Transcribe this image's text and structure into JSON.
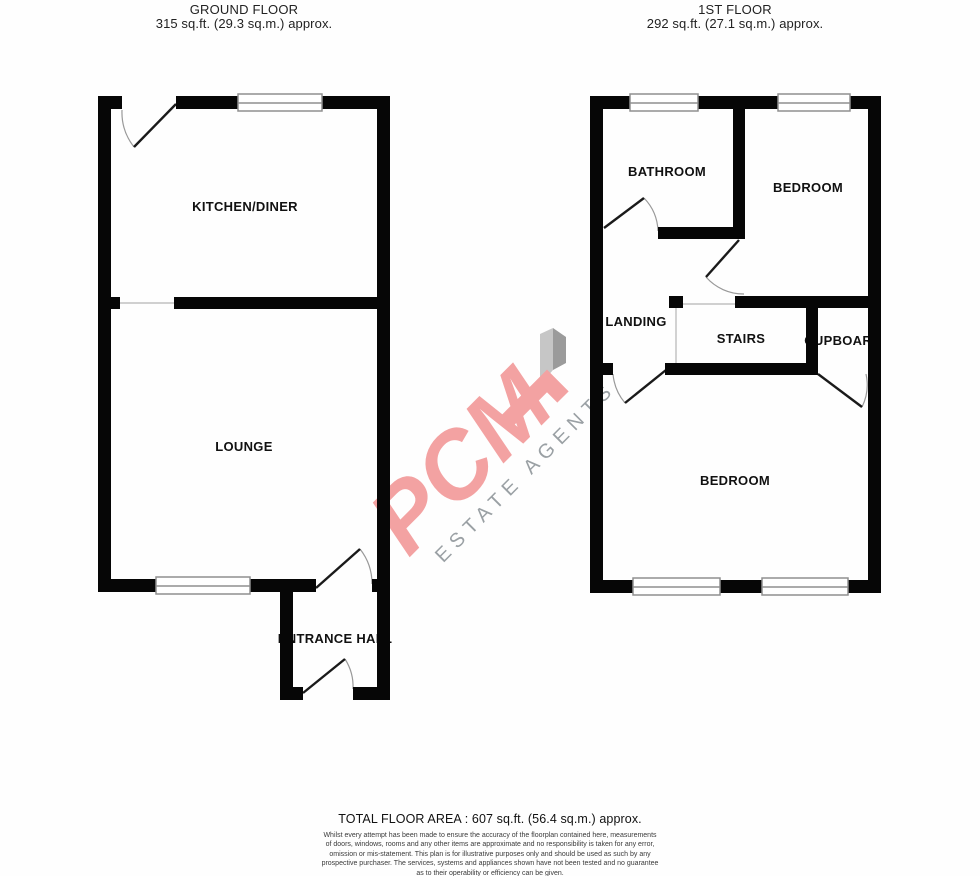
{
  "ground_floor": {
    "title": "GROUND FLOOR",
    "area": "315 sq.ft. (29.3 sq.m.) approx.",
    "rooms": {
      "kitchen_diner": "KITCHEN/DINER",
      "lounge": "LOUNGE",
      "entrance_hall": "ENTRANCE HALL"
    }
  },
  "first_floor": {
    "title": "1ST FLOOR",
    "area": "292 sq.ft. (27.1 sq.m.) approx.",
    "rooms": {
      "bathroom": "BATHROOM",
      "bedroom_front": "BEDROOM",
      "landing": "LANDING",
      "stairs": "STAIRS",
      "cupboard": "CUPBOARD",
      "bedroom_back": "BEDROOM"
    }
  },
  "watermark": {
    "brand": "PCM",
    "tagline": "ESTATE AGENTS",
    "brand_color": "#f3a2a2",
    "tagline_color": "#9aa0a4",
    "decor_light": "#c6c6c6",
    "decor_dark": "#9b9b9b"
  },
  "footer": {
    "total_area": "TOTAL FLOOR AREA : 607 sq.ft. (56.4 sq.m.) approx.",
    "disclaimer_lines": [
      "Whilst every attempt has been made to ensure the accuracy of the floorplan contained here, measurements",
      "of doors, windows, rooms and any other items are approximate and no responsibility is taken for any error,",
      "omission or mis-statement. This plan is for illustrative purposes only and should be used as such by any",
      "prospective purchaser. The services, systems and appliances shown have not been tested and no guarantee",
      "as to their operability or efficiency can be given.",
      "Made with Metropix ©2021"
    ]
  },
  "colors": {
    "wall": "#060606",
    "window_frame": "#8f8f8f",
    "door_leaf": "#1a1a1a",
    "door_arc": "#999999",
    "thin_line": "#b5b5b5",
    "label": "#111111"
  }
}
